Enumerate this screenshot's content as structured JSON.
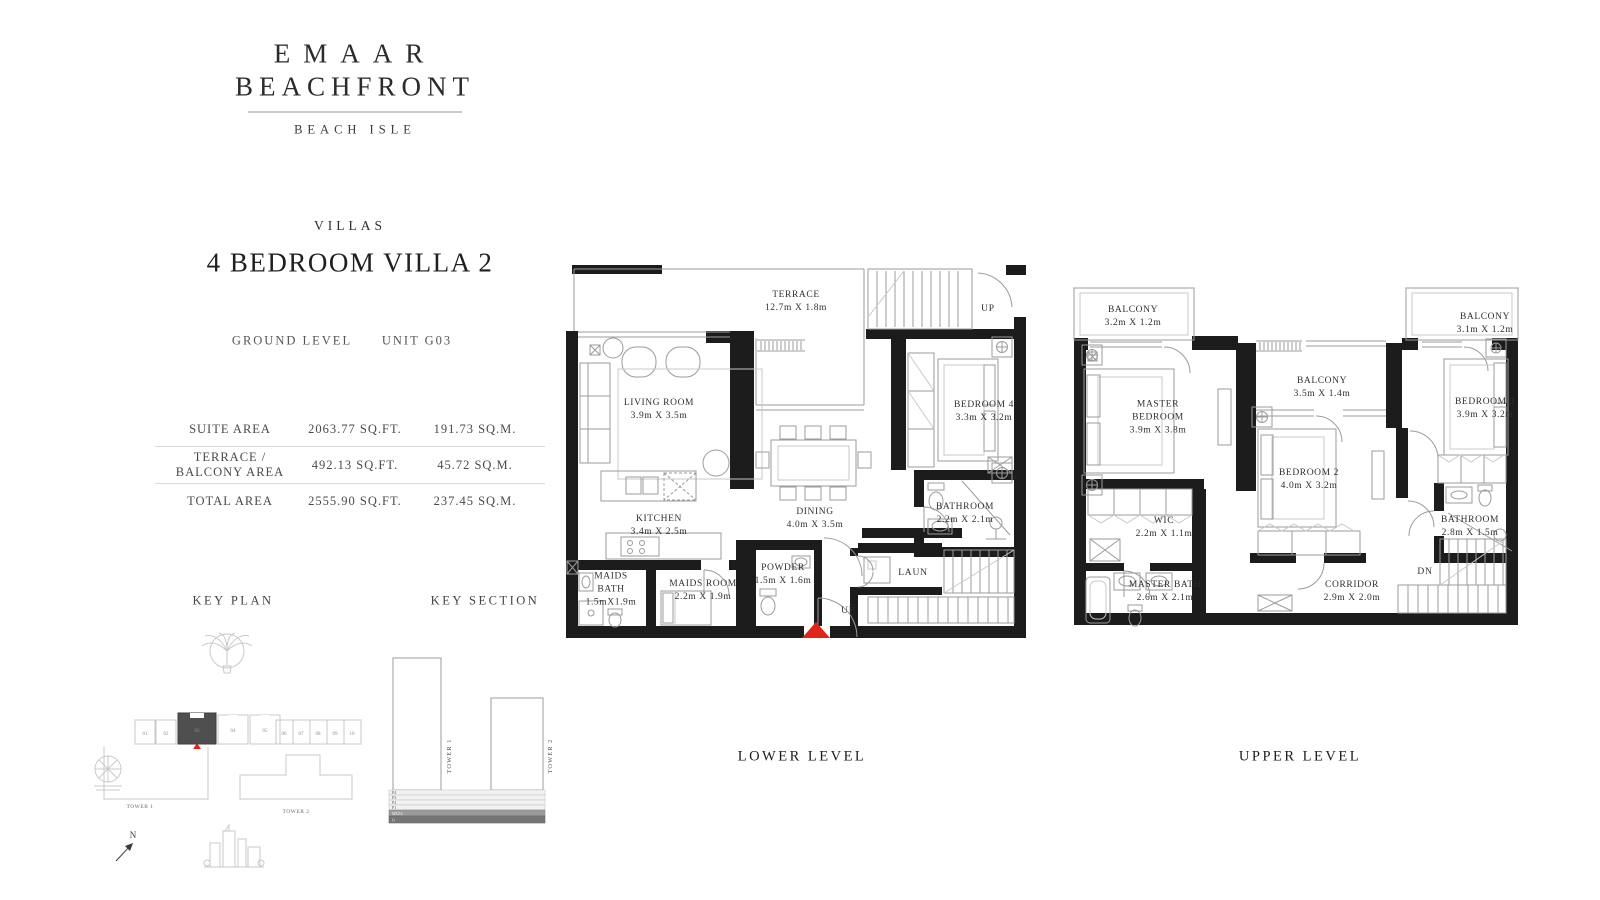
{
  "brand": {
    "name_line1": "EMAAR",
    "name_line2": "BEACHFRONT",
    "subtitle": "BEACH ISLE"
  },
  "header": {
    "category": "VILLAS",
    "title": "4 BEDROOM VILLA 2",
    "level": "GROUND LEVEL",
    "unit": "UNIT G03"
  },
  "area_table": {
    "rows": [
      {
        "label": "SUITE AREA",
        "sqft": "2063.77 SQ.FT.",
        "sqm": "191.73 SQ.M."
      },
      {
        "label": "TERRACE / BALCONY AREA",
        "sqft": "492.13 SQ.FT.",
        "sqm": "45.72 SQ.M."
      },
      {
        "label": "TOTAL AREA",
        "sqft": "2555.90 SQ.FT.",
        "sqm": "237.45 SQ.M."
      }
    ]
  },
  "key_plan": {
    "heading": "KEY PLAN",
    "tower1": "TOWER 1",
    "tower2": "TOWER 2",
    "north": "N",
    "units": [
      "01",
      "02",
      "03",
      "04",
      "05",
      "06",
      "07",
      "08",
      "09",
      "10"
    ],
    "highlighted_unit": "03"
  },
  "key_section": {
    "heading": "KEY SECTION",
    "tower1": "TOWER 1",
    "tower2": "TOWER 2",
    "floors": [
      "P4",
      "P3",
      "P2",
      "P1",
      "MEZZ",
      "G"
    ]
  },
  "lower_level": {
    "caption": "LOWER LEVEL",
    "stairs_up": "UP",
    "entry_up": "UP",
    "rooms": {
      "terrace": {
        "name": "TERRACE",
        "dims": "12.7m X 1.8m"
      },
      "living_room": {
        "name": "LIVING ROOM",
        "dims": "3.9m X 3.5m"
      },
      "bedroom4": {
        "name": "BEDROOM 4",
        "dims": "3.3m X 3.2m"
      },
      "dining": {
        "name": "DINING",
        "dims": "4.0m X 3.5m"
      },
      "kitchen": {
        "name": "KITCHEN",
        "dims": "3.4m X 2.5m"
      },
      "maids_bath": {
        "name": "MAIDS BATH",
        "dims": "1.5mX1.9m"
      },
      "maids_room": {
        "name": "MAIDS ROOM",
        "dims": "2.2m X 1.9m"
      },
      "powder": {
        "name": "POWDER",
        "dims": "1.5m X 1.6m"
      },
      "bathroom": {
        "name": "BATHROOM",
        "dims": "2.2m X 2.1m"
      },
      "laundry": {
        "name": "LAUN"
      }
    }
  },
  "upper_level": {
    "caption": "UPPER LEVEL",
    "stairs_down": "DN",
    "rooms": {
      "balcony_left": {
        "name": "BALCONY",
        "dims": "3.2m X 1.2m"
      },
      "balcony_center": {
        "name": "BALCONY",
        "dims": "3.5m X 1.4m"
      },
      "balcony_right": {
        "name": "BALCONY",
        "dims": "3.1m X 1.2m"
      },
      "master_bedroom": {
        "name": "MASTER BEDROOM",
        "dims": "3.9m X 3.8m"
      },
      "bedroom2": {
        "name": "BEDROOM 2",
        "dims": "4.0m X 3.2m"
      },
      "bedroom3": {
        "name": "BEDROOM 3",
        "dims": "3.9m X 3.2m"
      },
      "wic": {
        "name": "WIC",
        "dims": "2.2m X 1.1m"
      },
      "master_bath": {
        "name": "MASTER BATH",
        "dims": "2.6m X 2.1m"
      },
      "bathroom": {
        "name": "BATHROOM",
        "dims": "2.8m X 1.5m"
      },
      "corridor": {
        "name": "CORRIDOR",
        "dims": "2.9m X 2.0m"
      }
    }
  },
  "colors": {
    "wall": "#1c1c1c",
    "thin_line": "#9b9b9b",
    "light_line": "#c9c9c9",
    "accent_red": "#e0241c",
    "text_dark": "#2b2b2b",
    "text_mid": "#4a4a4a"
  }
}
